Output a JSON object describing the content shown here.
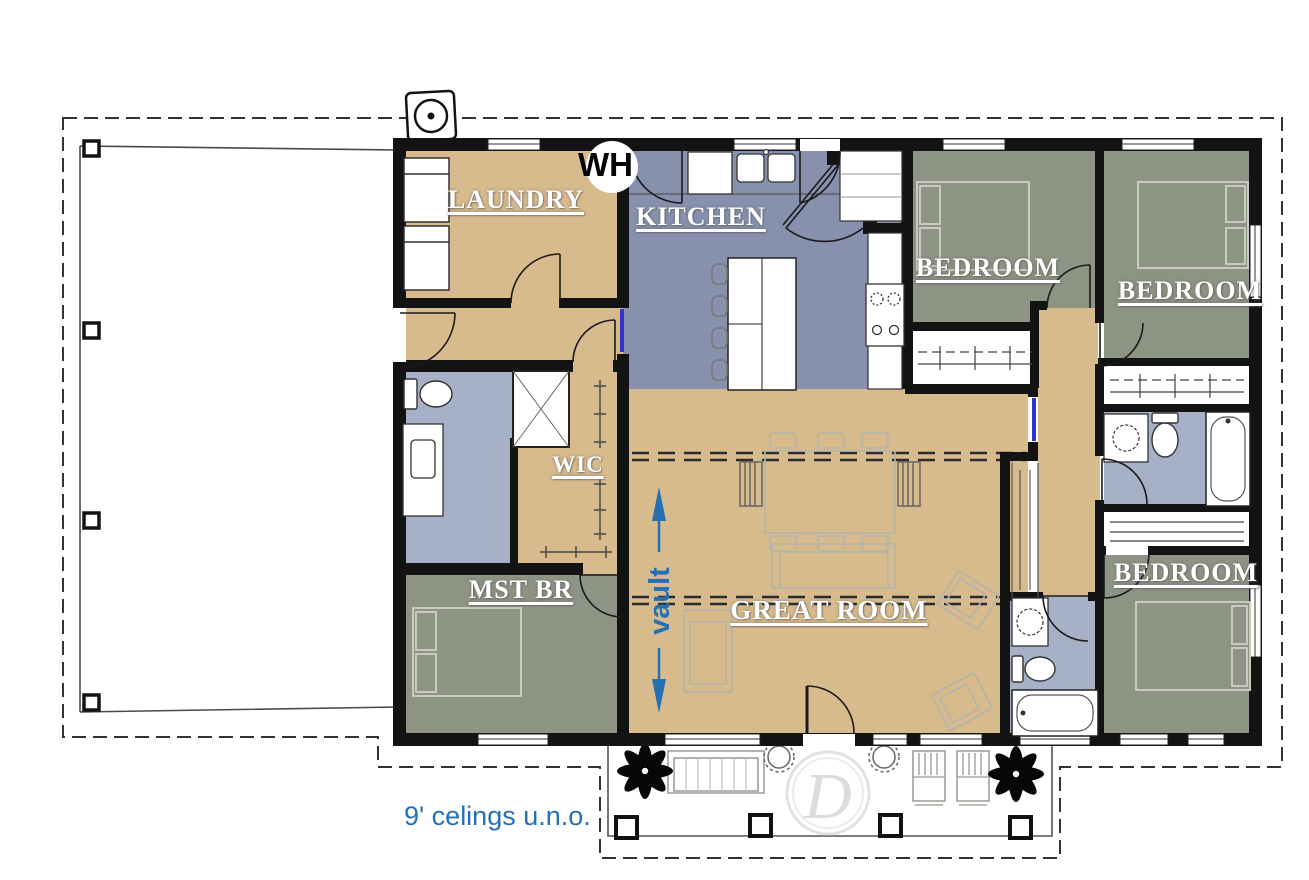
{
  "colors": {
    "wall_black": "#131313",
    "floor_tan": "#d8bb8d",
    "kitchen_blue_gray": "#8791ae",
    "bedroom_sage": "#8e9484",
    "bath_blue_gray": "#a6b0c6",
    "annotation_blue": "#2470b3",
    "pocket_door_blue": "#3333cc",
    "logo_gray": "#dcdcdc"
  },
  "rooms": {
    "laundry": {
      "label": "LAUNDRY"
    },
    "kitchen": {
      "label": "KITCHEN"
    },
    "bedroom_top_middle": {
      "label": "BEDROOM"
    },
    "bedroom_top_right": {
      "label": "BEDROOM"
    },
    "bedroom_bottom_right": {
      "label": "BEDROOM"
    },
    "wic": {
      "label": "WIC"
    },
    "master_bedroom": {
      "label": "MST BR"
    },
    "great_room": {
      "label": "GREAT ROOM"
    }
  },
  "annotations": {
    "vault_label": "vault",
    "water_heater_label": "WH",
    "ceiling_note": "9' celings u.n.o.",
    "logo_letter": "D"
  }
}
